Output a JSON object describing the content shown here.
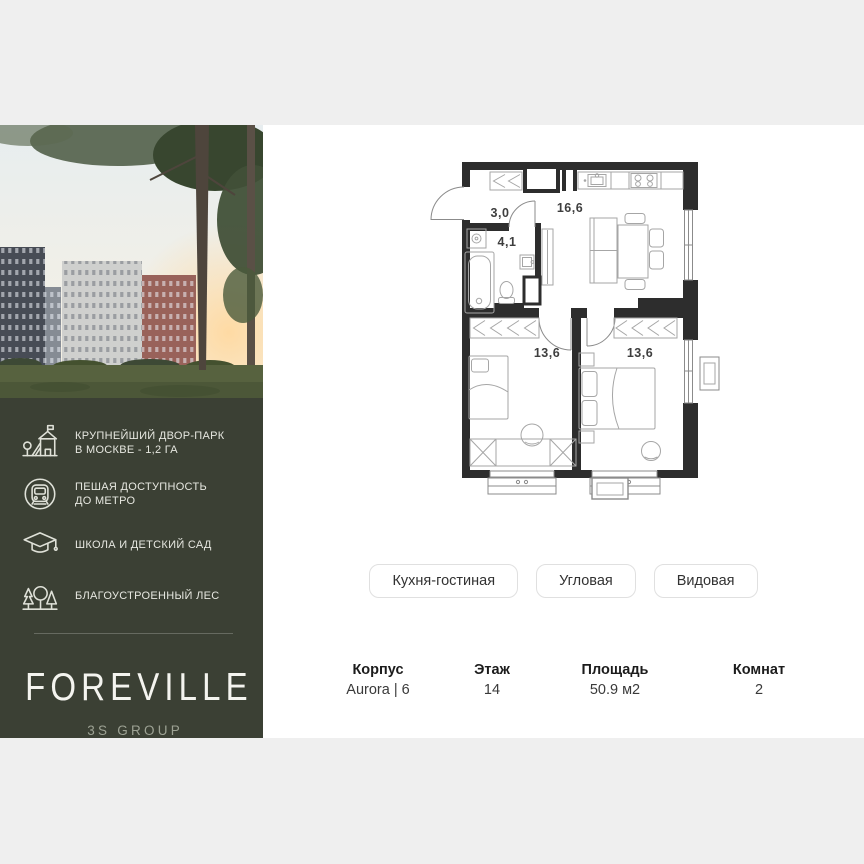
{
  "page": {
    "background": "#efefef",
    "content_background": "#ffffff",
    "brand_panel_color": "#3b4034"
  },
  "brand": {
    "name": "FOREVILLE",
    "group": "3S GROUP",
    "features": [
      {
        "icon": "playground-icon",
        "lines": [
          "КРУПНЕЙШИЙ ДВОР-ПАРК",
          "В МОСКВЕ - 1,2 ГА"
        ]
      },
      {
        "icon": "metro-icon",
        "lines": [
          "ПЕШАЯ ДОСТУПНОСТЬ",
          "ДО МЕТРО"
        ]
      },
      {
        "icon": "school-icon",
        "lines": [
          "ШКОЛА И ДЕТСКИЙ САД"
        ]
      },
      {
        "icon": "forest-icon",
        "lines": [
          "БЛАГОУСТРОЕННЫЙ ЛЕС"
        ]
      }
    ]
  },
  "floorplan": {
    "rooms": [
      {
        "name": "hallway",
        "area": "3,0"
      },
      {
        "name": "kitchen-living",
        "area": "16,6"
      },
      {
        "name": "bathroom",
        "area": "4,1"
      },
      {
        "name": "bedroom-left",
        "area": "13,6"
      },
      {
        "name": "bedroom-right",
        "area": "13,6"
      }
    ]
  },
  "tags": [
    "Кухня-гостиная",
    "Угловая",
    "Видовая"
  ],
  "details": [
    {
      "label": "Корпус",
      "value": "Aurora | 6"
    },
    {
      "label": "Этаж",
      "value": "14"
    },
    {
      "label": "Площадь",
      "value": "50.9 м2"
    },
    {
      "label": "Комнат",
      "value": "2"
    }
  ]
}
